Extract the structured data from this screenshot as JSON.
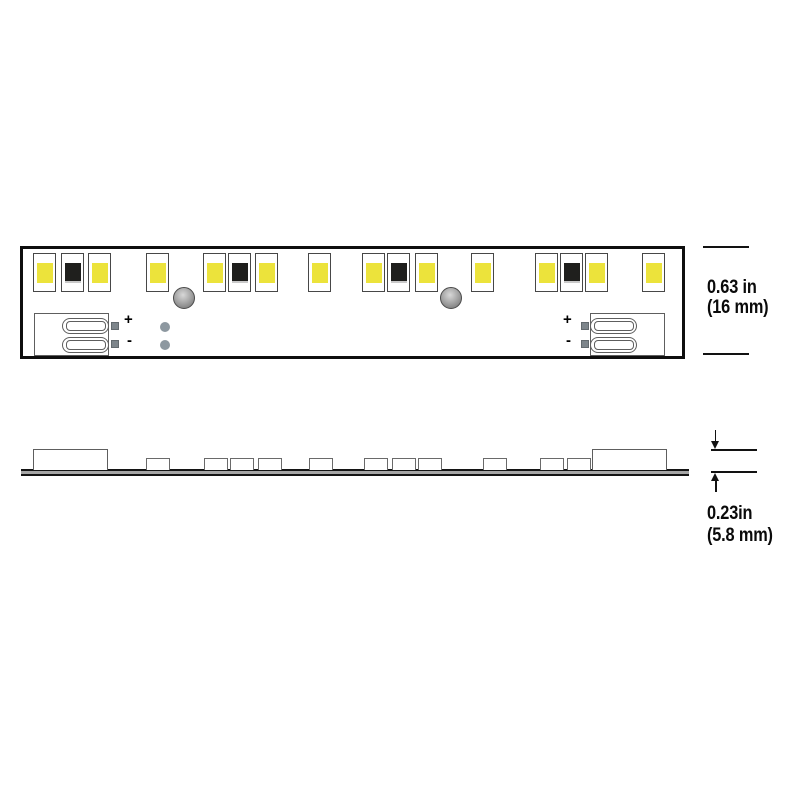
{
  "labels": {
    "plus": "+",
    "minus": "-"
  },
  "dimensions": {
    "height": {
      "line1": "0.63 in",
      "line2": "(16 mm)"
    },
    "thickness": {
      "line1": "0.23in",
      "line2": "(5.8 mm)"
    }
  },
  "colors": {
    "led_yellow": "#ece33b",
    "led_dark": "#1f1f1d",
    "strip_outline": "#0e0e0e",
    "component_outline": "#5e5e5e",
    "pad_gray": "#7d858b",
    "via_gray": "#8d98a0",
    "pcb_gray": "#a5a5a5"
  },
  "top_view": {
    "strip": {
      "x": 20,
      "y": 246,
      "width": 665,
      "height": 113
    },
    "led_row_y": 253,
    "leds": [
      {
        "x": 33,
        "chip": "yellow"
      },
      {
        "x": 61,
        "chip": "dark"
      },
      {
        "x": 88,
        "chip": "yellow"
      },
      {
        "x": 146,
        "chip": "yellow"
      },
      {
        "x": 203,
        "chip": "yellow"
      },
      {
        "x": 228,
        "chip": "dark"
      },
      {
        "x": 255,
        "chip": "yellow"
      },
      {
        "x": 308,
        "chip": "yellow"
      },
      {
        "x": 362,
        "chip": "yellow"
      },
      {
        "x": 387,
        "chip": "dark"
      },
      {
        "x": 415,
        "chip": "yellow"
      },
      {
        "x": 471,
        "chip": "yellow"
      },
      {
        "x": 535,
        "chip": "yellow"
      },
      {
        "x": 560,
        "chip": "dark"
      },
      {
        "x": 585,
        "chip": "yellow"
      },
      {
        "x": 642,
        "chip": "yellow"
      }
    ],
    "holes": [
      {
        "cx": 184,
        "cy": 298
      },
      {
        "cx": 451,
        "cy": 298
      }
    ],
    "connectors": [
      {
        "side": "left",
        "rect_x": 34,
        "pill_x": 62,
        "pads_x": 111,
        "plus_x": 124,
        "minus_x": 127
      },
      {
        "side": "right",
        "rect_x": 590,
        "pill_x": 590,
        "pads_x": 581,
        "plus_x": 563,
        "minus_x": 566
      }
    ],
    "vias": [
      {
        "cx": 165,
        "cy": 327
      },
      {
        "cx": 165,
        "cy": 345
      }
    ]
  },
  "side_view": {
    "bar": {
      "x": 21,
      "y": 469,
      "width": 668,
      "height": 7
    },
    "connector_boxes": [
      {
        "x": 33
      },
      {
        "x": 592
      }
    ],
    "bumps": [
      146,
      204,
      230,
      258,
      309,
      364,
      392,
      418,
      483,
      540,
      567
    ]
  }
}
